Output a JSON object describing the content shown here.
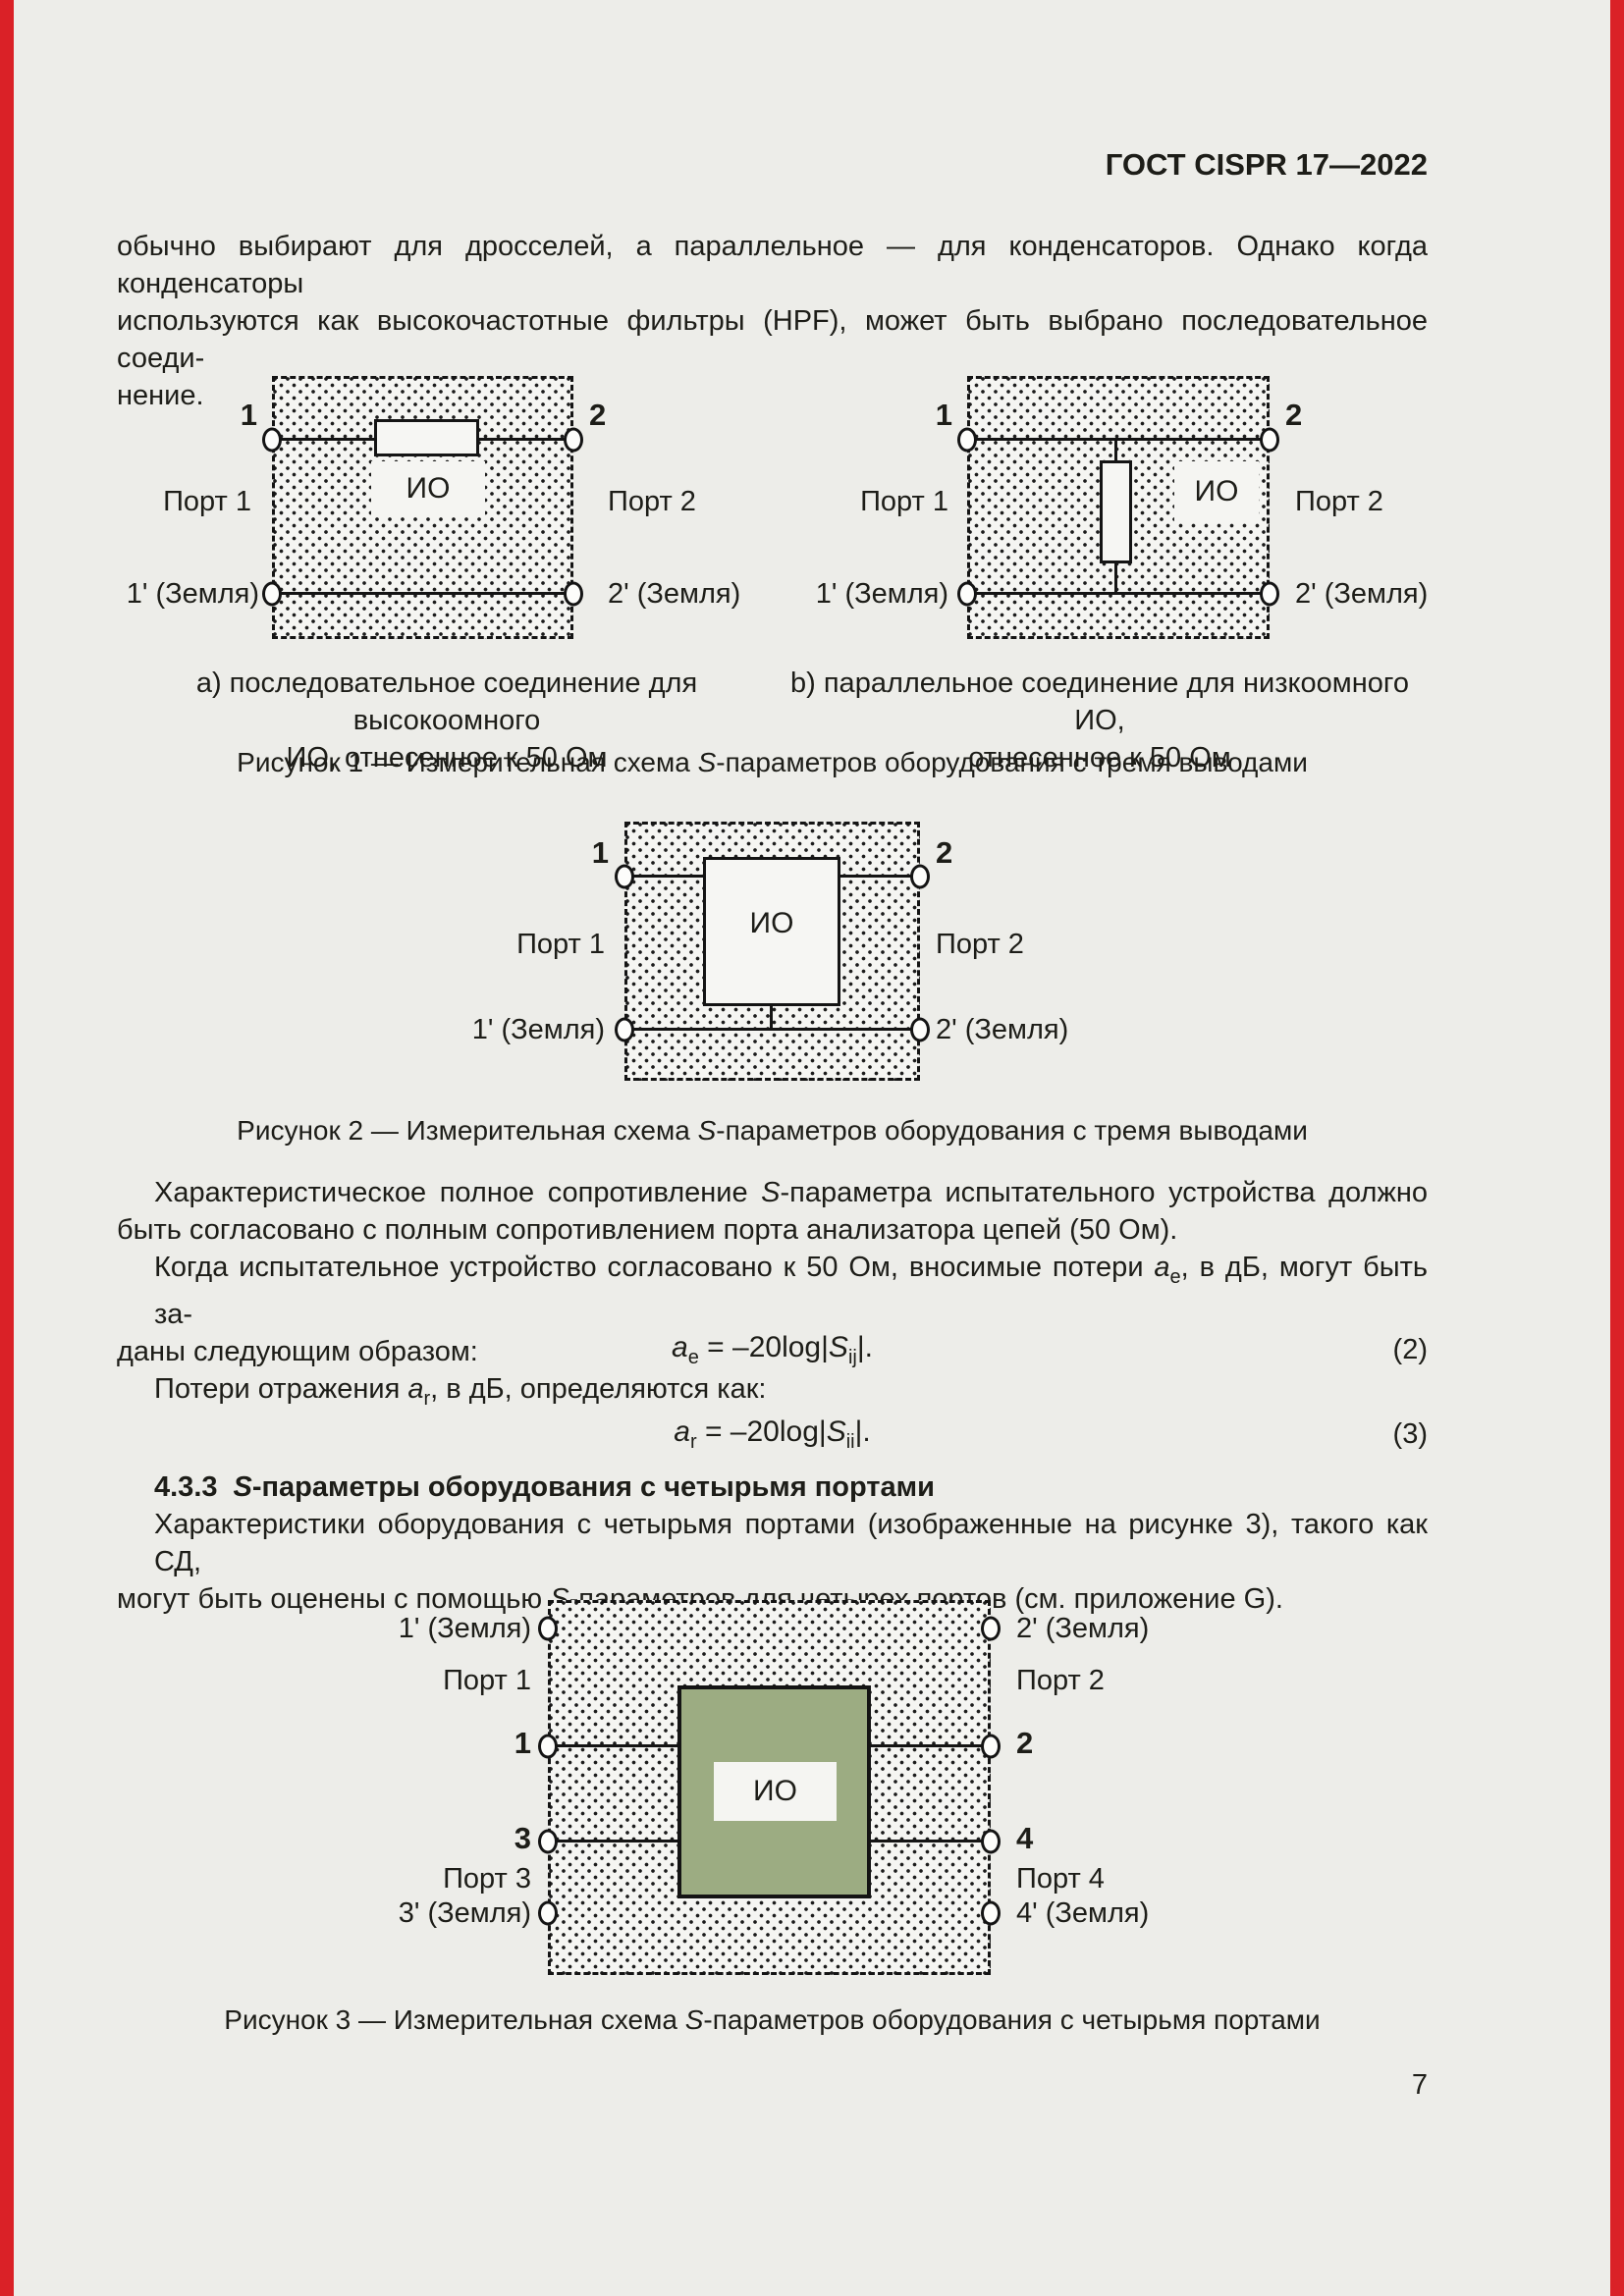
{
  "page": {
    "number": "7"
  },
  "header": {
    "title": "ГОСТ CISPR 17—2022"
  },
  "intro": {
    "line1": "обычно выбирают для дросселей, а параллельное — для конденсаторов. Однако когда конденсаторы",
    "line2": "используются как высокочастотные фильтры (HPF), может быть выбрано последовательное соеди-",
    "line3": "нение."
  },
  "fig1": {
    "a": {
      "pin_top_left": "1",
      "pin_top_right": "2",
      "device": "ИО",
      "port_left": "Порт 1",
      "port_right": "Порт 2",
      "gnd_left": "1' (Земля)",
      "gnd_right": "2' (Земля)",
      "cap1": "a) последовательное соединение для высокоомного",
      "cap2": "ИО, отнесенное к 50 Ом"
    },
    "b": {
      "pin_top_left": "1",
      "pin_top_right": "2",
      "device": "ИО",
      "port_left": "Порт 1",
      "port_right": "Порт 2",
      "gnd_left": "1' (Земля)",
      "gnd_right": "2' (Земля)",
      "cap1": "b) параллельное соединение для низкоомного ИО,",
      "cap2": "отнесенное к 50 Ом"
    },
    "caption_pre": "Рисунок 1 — Измерительная схема ",
    "caption_s": "S",
    "caption_post": "-параметров оборудования с тремя выводами"
  },
  "fig2": {
    "pin_left": "1",
    "pin_right": "2",
    "device": "ИО",
    "port_left": "Порт 1",
    "port_right": "Порт 2",
    "gnd_left": "1' (Земля)",
    "gnd_right": "2' (Земля)",
    "caption_pre": "Рисунок 2 — Измерительная схема ",
    "caption_s": "S",
    "caption_post": "-параметров оборудования с тремя выводами"
  },
  "para1": {
    "l1_pre": "Характеристическое полное сопротивление ",
    "l1_s": "S",
    "l1_post": "-параметра испытательного устройства должно",
    "l2": "быть согласовано с полным сопротивлением порта анализатора цепей (50 Ом)."
  },
  "para2": {
    "l1_pre": "Когда испытательное устройство согласовано к 50 Ом, вносимые потери ",
    "l1_var": "a",
    "l1_sub": "e",
    "l1_post": ", в дБ, могут быть за-",
    "l2": "даны следующим образом:"
  },
  "eq2": {
    "var": "a",
    "sub": "e",
    "mid": " = –20log|",
    "s": "S",
    "s_sub": "ij",
    "end": "|.",
    "num": "(2)"
  },
  "para3": {
    "pre": "Потери отражения ",
    "var": "a",
    "sub": "r",
    "post": ", в дБ, определяются как:"
  },
  "eq3": {
    "var": "a",
    "sub": "r",
    "mid": " = –20log|",
    "s": "S",
    "s_sub": "ii",
    "end": "|.",
    "num": "(3)"
  },
  "sec433": {
    "num": "4.3.3",
    "s": "S",
    "rest": "-параметры оборудования с четырьмя портами"
  },
  "para4": {
    "l1": "Характеристики оборудования с четырьмя портами (изображенные на рисунке 3), такого как СД,",
    "l2_pre": "могут быть оценены с помощью ",
    "l2_s": "S",
    "l2_post": "-параметров для четырех портов (см. приложение G)."
  },
  "fig3": {
    "gnd_tl": "1' (Земля)",
    "gnd_tr": "2' (Земля)",
    "port1": "Порт 1",
    "port2": "Порт 2",
    "pin1": "1",
    "pin2": "2",
    "pin3": "3",
    "pin4": "4",
    "port3": "Порт 3",
    "port4": "Порт 4",
    "gnd_bl": "3' (Земля)",
    "gnd_br": "4' (Земля)",
    "device": "ИО",
    "caption_pre": "Рисунок 3 — Измерительная схема ",
    "caption_s": "S",
    "caption_post": "-параметров оборудования с четырьмя портами"
  }
}
